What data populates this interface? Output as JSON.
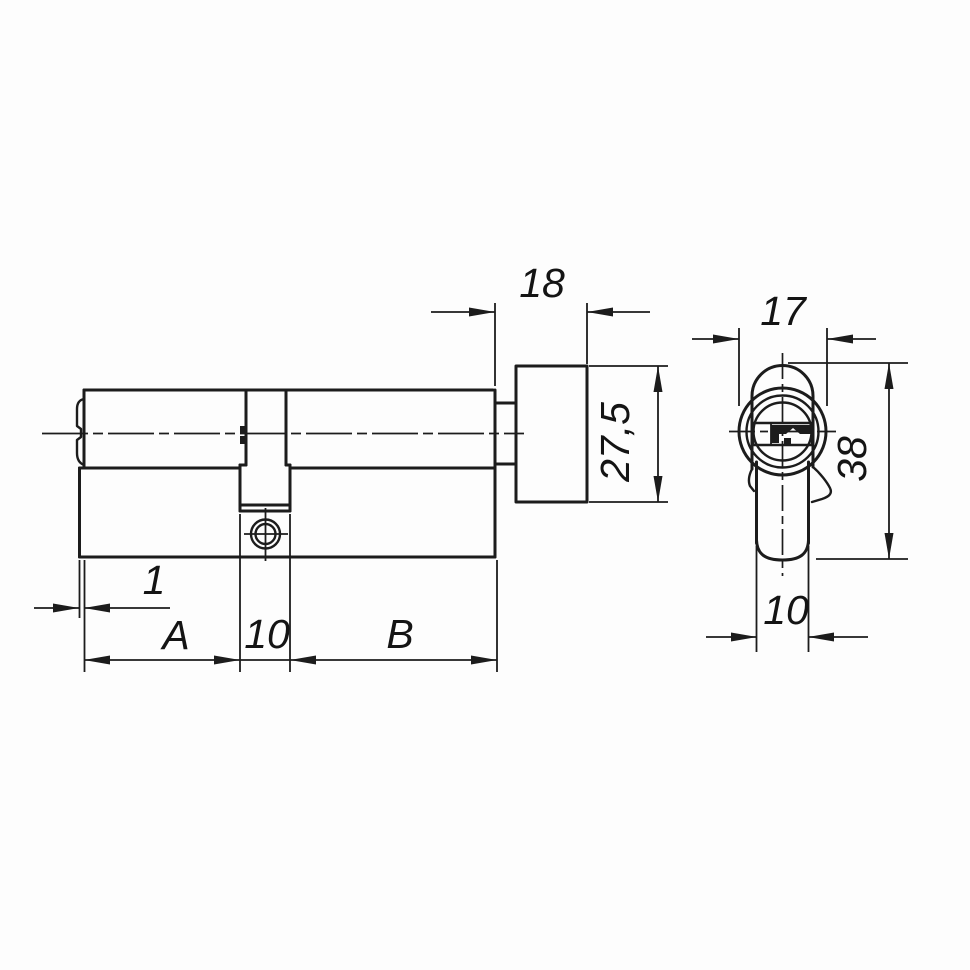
{
  "diagram": {
    "type": "technical_drawing",
    "subject": "profile cylinder lock with thumbturn, dimensioned two-view drawing",
    "colors": {
      "background": "#fdfdfd",
      "line": "#1c1c1c",
      "text": "#141414"
    },
    "front_view": {
      "name": "front-view",
      "dims": {
        "knob_depth": "18",
        "knob_height": "27,5",
        "face_step": "1",
        "left_length": "A",
        "cam_width": "10",
        "right_length": "B"
      }
    },
    "side_view": {
      "name": "side-view",
      "dims": {
        "barrel_diameter": "17",
        "total_height": "38",
        "body_width": "10"
      }
    }
  }
}
